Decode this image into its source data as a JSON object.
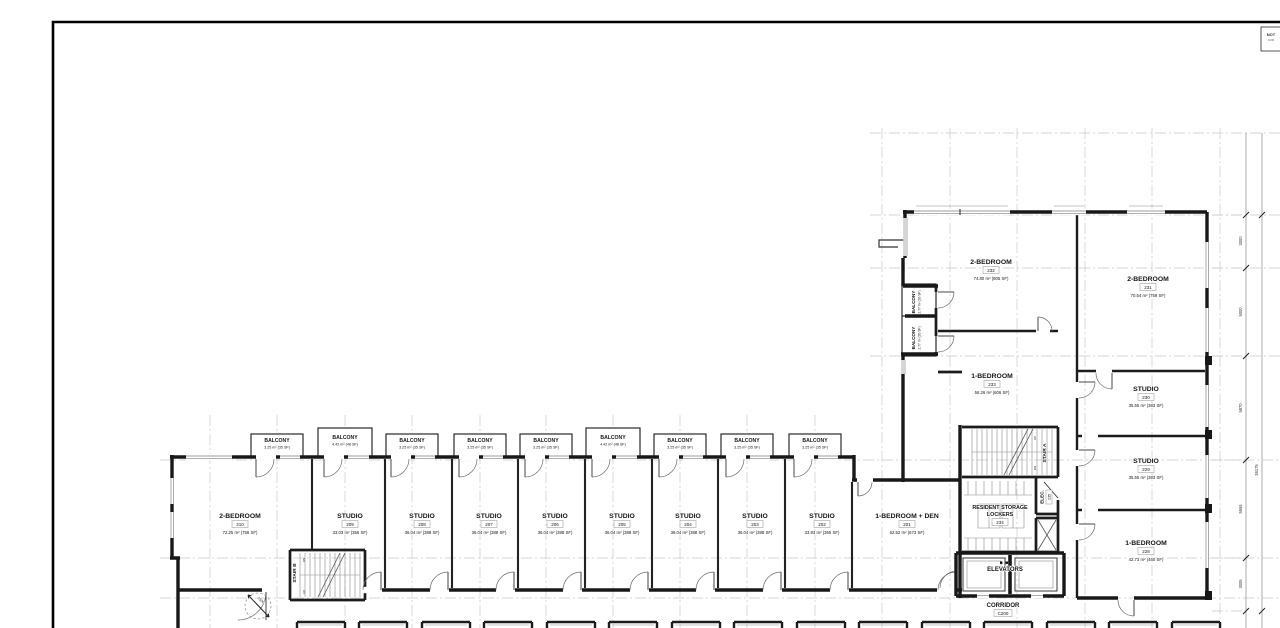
{
  "colors": {
    "wall": "#181818",
    "grid": "#c9c9c9",
    "paper": "#ffffff"
  },
  "stamp": {
    "line1": "NOT",
    "line2": "FOR"
  },
  "rooms": [
    {
      "name": "2-BEDROOM",
      "tag": "210",
      "area": "72.25 m² (756 SF)"
    },
    {
      "name": "STUDIO",
      "tag": "209",
      "area": "33.03 m² (356 SF)"
    },
    {
      "name": "STUDIO",
      "tag": "208",
      "area": "36.04 m² (388 SF)"
    },
    {
      "name": "STUDIO",
      "tag": "207",
      "area": "36.04 m² (388 SF)"
    },
    {
      "name": "STUDIO",
      "tag": "206",
      "area": "36.04 m² (388 SF)"
    },
    {
      "name": "STUDIO",
      "tag": "205",
      "area": "36.04 m² (388 SF)"
    },
    {
      "name": "STUDIO",
      "tag": "204",
      "area": "36.04 m² (388 SF)"
    },
    {
      "name": "STUDIO",
      "tag": "203",
      "area": "36.04 m² (388 SF)"
    },
    {
      "name": "STUDIO",
      "tag": "202",
      "area": "33.93 m² (365 SF)"
    },
    {
      "name": "1-BEDROOM + DEN",
      "tag": "201",
      "area": "62.52 m² (673 SF)"
    },
    {
      "name": "2-BEDROOM",
      "tag": "232",
      "area": "74.80 m² (805 SF)"
    },
    {
      "name": "2-BEDROOM",
      "tag": "231",
      "area": "70.54 m² (759 SF)"
    },
    {
      "name": "1-BEDROOM",
      "tag": "233",
      "area": "56.26 m² (606 SF)"
    },
    {
      "name": "STUDIO",
      "tag": "230",
      "area": "35.55 m² (383 SF)"
    },
    {
      "name": "STUDIO",
      "tag": "229",
      "area": "35.55 m² (383 SF)"
    },
    {
      "name": "1-BEDROOM",
      "tag": "228",
      "area": "42.73 m² (460 SF)"
    }
  ],
  "balcony_row": [
    {
      "label": "BALCONY",
      "area": "3.25 m² (35 SF)"
    },
    {
      "label": "BALCONY",
      "area": "4.42 m² (48 SF)"
    },
    {
      "label": "BALCONY",
      "area": "3.25 m² (35 SF)"
    },
    {
      "label": "BALCONY",
      "area": "3.25 m² (35 SF)"
    },
    {
      "label": "BALCONY",
      "area": "3.25 m² (35 SF)"
    },
    {
      "label": "BALCONY",
      "area": "4.42 m² (48 SF)"
    },
    {
      "label": "BALCONY",
      "area": "3.25 m² (35 SF)"
    },
    {
      "label": "BALCONY",
      "area": "3.25 m² (35 SF)"
    },
    {
      "label": "BALCONY",
      "area": "3.25 m² (35 SF)"
    }
  ],
  "side_balconies": [
    {
      "label": "BALCONY",
      "area": "2.77 m² (30 SF)"
    },
    {
      "label": "BALCONY",
      "area": "2.77 m² (30 SF)"
    }
  ],
  "core": {
    "stair_a": "STAIR A",
    "stair_b": "STAIR B",
    "elec_label": "ELEC.",
    "elec_tag": "235",
    "storage_line1": "RESIDENT STORAGE",
    "storage_line2": "LOCKERS",
    "storage_tag": "234",
    "elevators_label": "ELEVATORS",
    "corridor_label": "CORRIDOR",
    "corridor_tag": "C200",
    "up_label": "UP",
    "dn_label": "DN"
  },
  "dimensions": {
    "right_chain": [
      "3000",
      "5000",
      "5870",
      "5555",
      "3005"
    ],
    "overall": "36175",
    "door_clearance": "1500"
  }
}
